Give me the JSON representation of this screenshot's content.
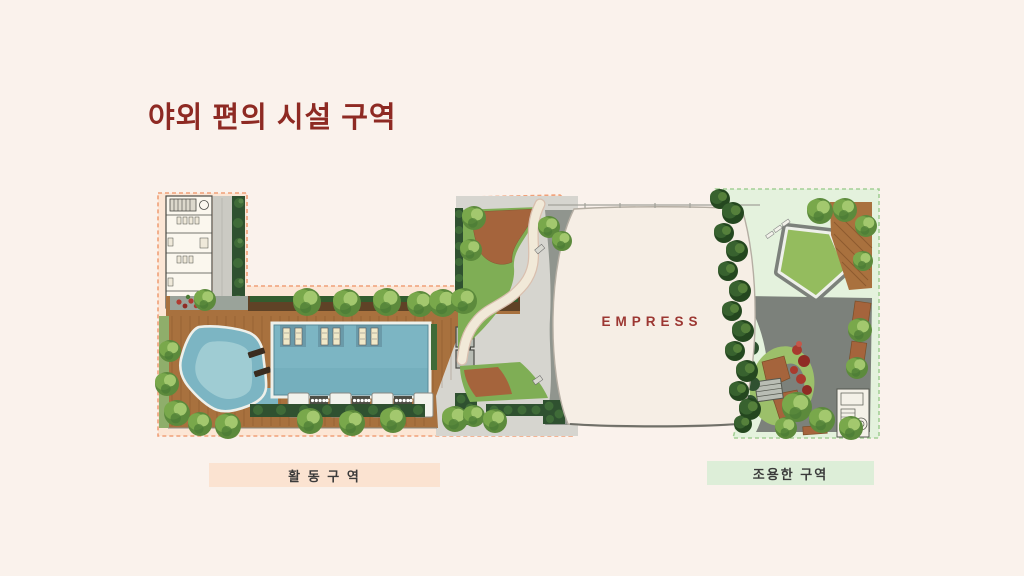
{
  "slide": {
    "background_color": "#faf2ec",
    "title": {
      "text": "야외 편의 시설 구역",
      "color": "#8e2a23"
    }
  },
  "plan": {
    "building_label": "EMPRESS",
    "building_label_color": "#9c3732",
    "zones": [
      {
        "id": "activity-zone",
        "label": "활 동 구 역",
        "fill": "#fce6d5",
        "border": "#f0a078",
        "label_bg": "#fbe3d1",
        "features": [
          "changing-room-building",
          "kids-pool",
          "lap-pool",
          "wood-deck",
          "cabana-row",
          "pool-lounger-pairs",
          "tree-row",
          "garden-path"
        ]
      },
      {
        "id": "quiet-zone",
        "label": "조용한 구역",
        "fill": "#e4f2dd",
        "border": "#a4d096",
        "label_bg": "#ddeed8",
        "features": [
          "central-lawn",
          "walking-path-ring",
          "wood-deck",
          "planters",
          "pergola",
          "garden-stair-structure",
          "trees"
        ]
      }
    ]
  }
}
